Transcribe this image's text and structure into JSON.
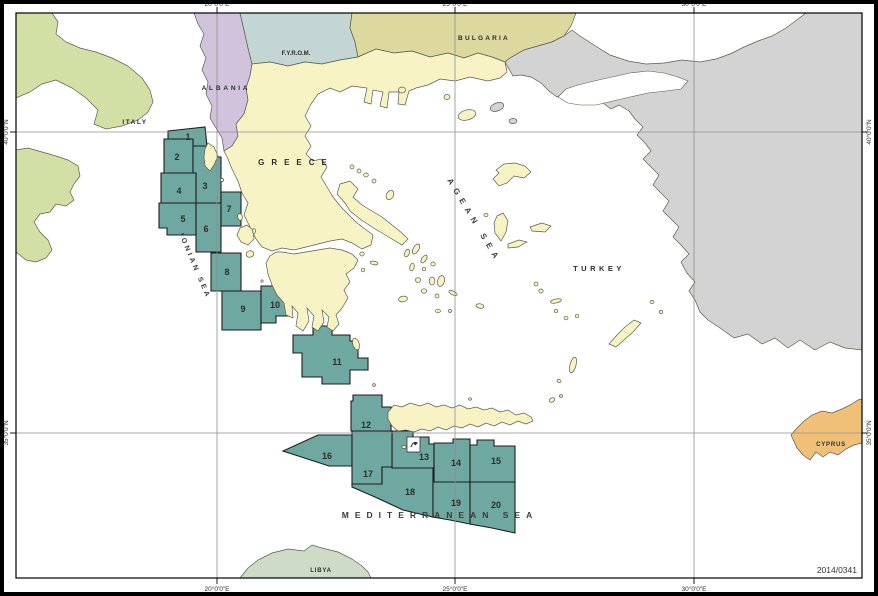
{
  "map": {
    "code": "2014/0341",
    "countries": {
      "italy": "ITALY",
      "albania": "ALBANIA",
      "fyrom": "F.Y.R.O.M.",
      "bulgaria": "BULGARIA",
      "greece": "GREECE",
      "turkey": "TURKEY",
      "cyprus": "CYPRUS",
      "libya": "LIBYA"
    },
    "seas": {
      "ionian": "IONIAN SEA",
      "aegean": "AGEAN SEA",
      "mediterranean": "MEDITERRANEAN SEA"
    },
    "blocks": {
      "ids": [
        "1",
        "2",
        "3",
        "4",
        "5",
        "6",
        "7",
        "8",
        "9",
        "10",
        "11",
        "12",
        "13",
        "14",
        "15",
        "16",
        "17",
        "18",
        "19",
        "20"
      ]
    },
    "axis": {
      "top": [
        "20°0'0\"E",
        "25°0'0\"E",
        "30°0'0\"E"
      ],
      "bottom": [
        "20°0'0\"E",
        "25°0'0\"E",
        "30°0'0\"E"
      ],
      "left": [
        "40°0'0\"N",
        "35°0'0\"N"
      ],
      "right": [
        "40°0'0\"N",
        "35°0'0\"N"
      ]
    },
    "icons": {
      "block13_marker": "nautical-symbol"
    },
    "colors": {
      "sea": "#ffffff",
      "blocks": "#6FA8A1",
      "block_number": "#2F5FC8",
      "greece": "#F7F3C4",
      "italy": "#D3E0A5",
      "albania": "#D0C3DB",
      "fyrom": "#C3D6D3",
      "bulgaria": "#DCD89E",
      "turkey": "#D3D3D3",
      "cyprus": "#F0C078",
      "libya": "#CDDBC7",
      "grid": "#8f8f8f"
    }
  }
}
